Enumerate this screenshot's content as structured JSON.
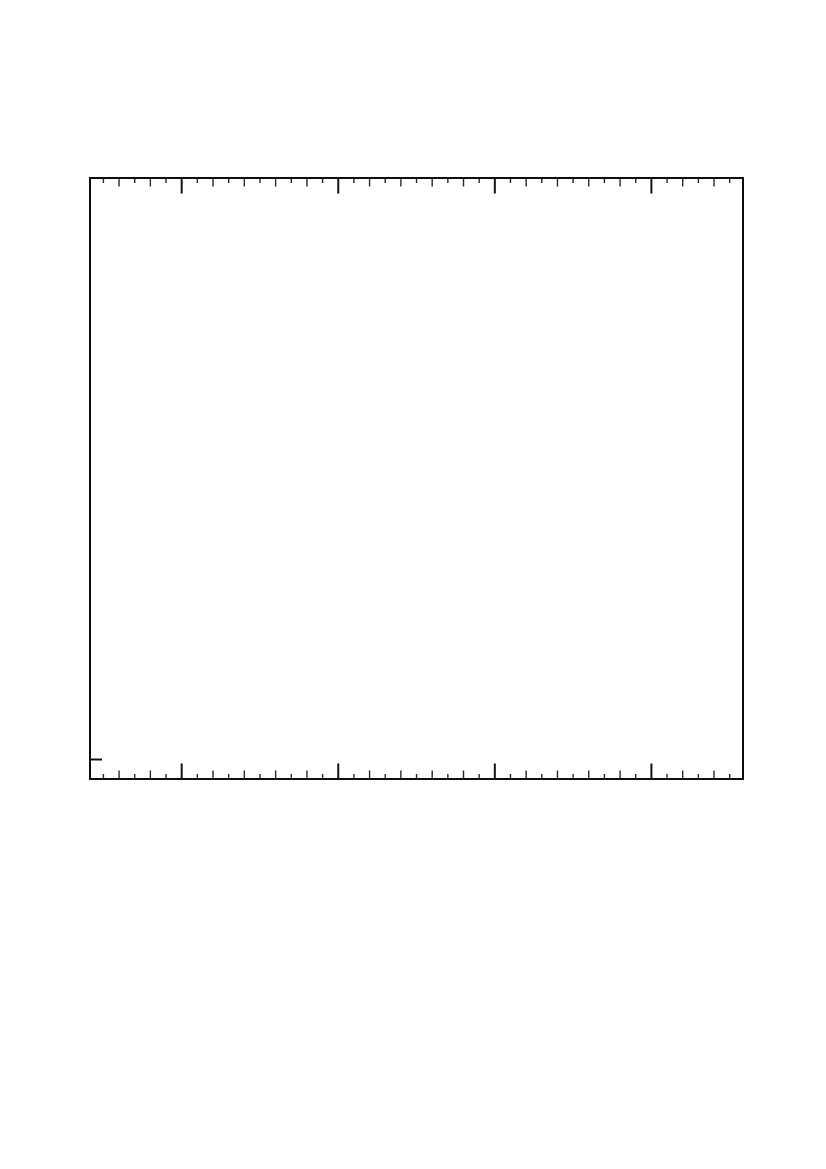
{
  "page": {
    "background_color": "#ffffff",
    "width_px": 826,
    "height_px": 1169
  },
  "chart_data": {
    "type": "line",
    "title": "",
    "xlabel": "",
    "ylabel": "",
    "series": [],
    "categories": [],
    "legend": {
      "visible": false,
      "entries": []
    },
    "grid": false,
    "annotations": [],
    "notes": "Empty ROOT-style plot frame: black rectangular axes box with unlabeled inward tick marks on the top and bottom edges, one short tick on the lower left edge, no data points, no tick labels, no text rendered anywhere.",
    "axes": {
      "x_axis": {
        "tick_labels_visible": false,
        "first_tick_px": 103.4,
        "tick_step_px": 15.657,
        "tick_count": 41,
        "major_tick_period": 10,
        "major_tick_first_index": 5,
        "major_tick_positions_px": [
          181.7,
          338.3,
          494.9,
          651.5
        ],
        "major_tick_len_px": 14.5,
        "medium_tick_len_px": 7.5,
        "minor_tick_len_px": 4,
        "drawn_on": [
          "top-edge",
          "bottom-edge"
        ]
      },
      "y_axis": {
        "tick_labels_visible": false,
        "ticks_px": [
          {
            "y": 759.5,
            "len": 11
          }
        ],
        "drawn_on": [
          "left-edge"
        ]
      }
    },
    "frame_px": {
      "left": 89,
      "top": 177,
      "width": 655,
      "height": 603,
      "border_width": 2
    },
    "colors": {
      "frame": "#0d0d0d",
      "major_tick": "#141414",
      "minor_tick": "#2a2a2a",
      "background": "#ffffff"
    }
  }
}
